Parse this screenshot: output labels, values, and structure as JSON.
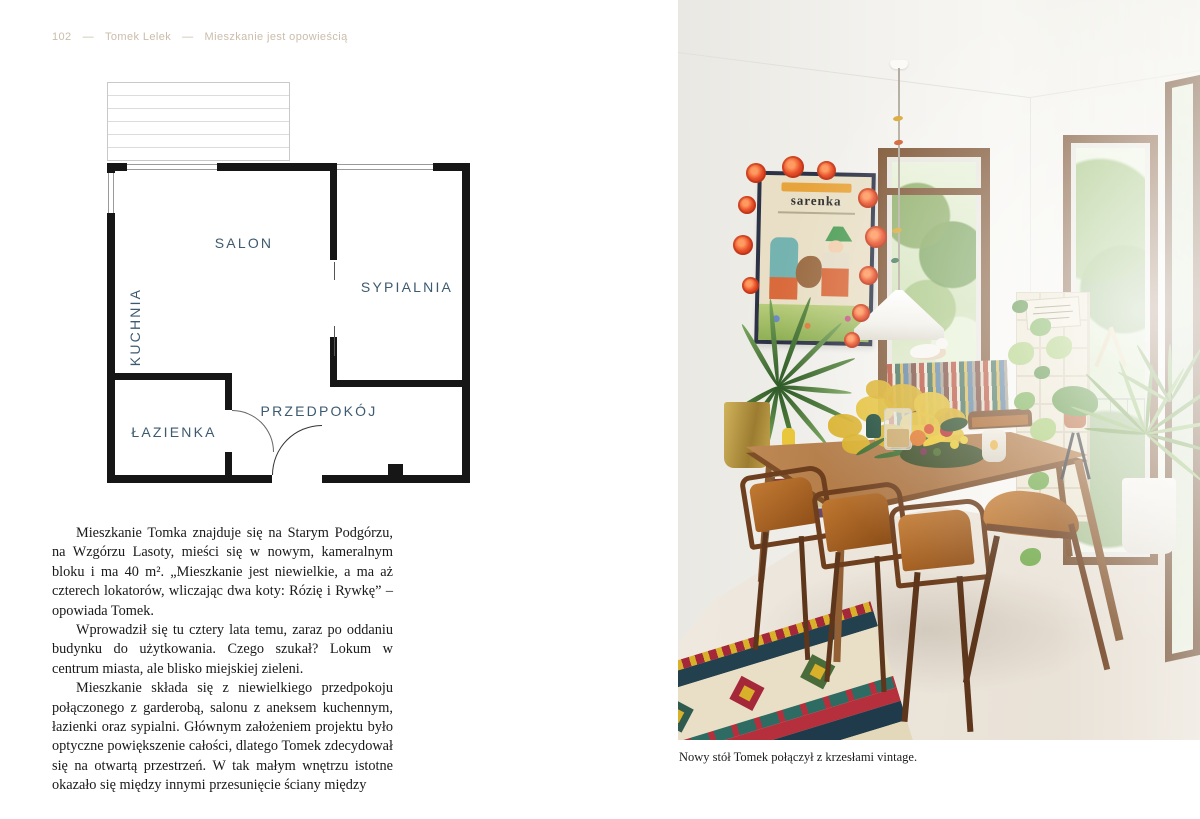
{
  "header": {
    "page_number": "102",
    "author": "Tomek Lelek",
    "book_title": "Mieszkanie jest opowieścią",
    "separator": "—"
  },
  "floor_plan": {
    "rooms": [
      {
        "id": "salon",
        "label": "SALON"
      },
      {
        "id": "sypialnia",
        "label": "SYPIALNIA"
      },
      {
        "id": "kuchnia",
        "label": "KUCHNIA"
      },
      {
        "id": "lazienka",
        "label": "ŁAZIENKA"
      },
      {
        "id": "przedpokoj",
        "label": "PRZEDPOKÓJ"
      }
    ]
  },
  "body": {
    "paragraphs": [
      "Mieszkanie Tomka znajduje się na Starym Podgórzu, na Wzgórzu Lasoty, mieści się w nowym, kameralnym bloku i ma 40 m². „Mieszkanie jest niewielkie, a ma aż czterech lokatorów, wliczając dwa koty: Rózię i Rywkę” – opowiada Tomek.",
      "Wprowadził się tu cztery lata temu, zaraz po oddaniu budynku do użytkowania. Czego szukał? Lokum w centrum miasta, ale blisko miejskiej zieleni.",
      "Mieszkanie składa się z niewielkiego przedpokoju połączonego z garderobą, salonu z aneksem kuchennym, łazienki oraz sypialni. Głównym założeniem projektu było optyczne powiększenie całości, dlatego Tomek zdecydował się na otwartą przestrzeń. W tak małym wnętrzu istotne okazało się między innymi przesunięcie ściany między"
    ]
  },
  "photo": {
    "caption": "Nowy stół Tomek połączył z krzesłami vintage.",
    "poster_title": "sarenka"
  },
  "colors": {
    "plan_label": "#3d5a70",
    "plan_wall": "#161616",
    "header_text": "#cbbcaa",
    "body_text": "#191919",
    "page_background": "#ffffff",
    "poster_frame": "#2d3347",
    "garland_flower": "#e84e28",
    "chair_velvet": "#a65e20",
    "table_wood": "#b08050",
    "rug_navy": "#1f3a4a",
    "rug_red": "#a5283a",
    "rug_cream": "#e9dec2"
  }
}
